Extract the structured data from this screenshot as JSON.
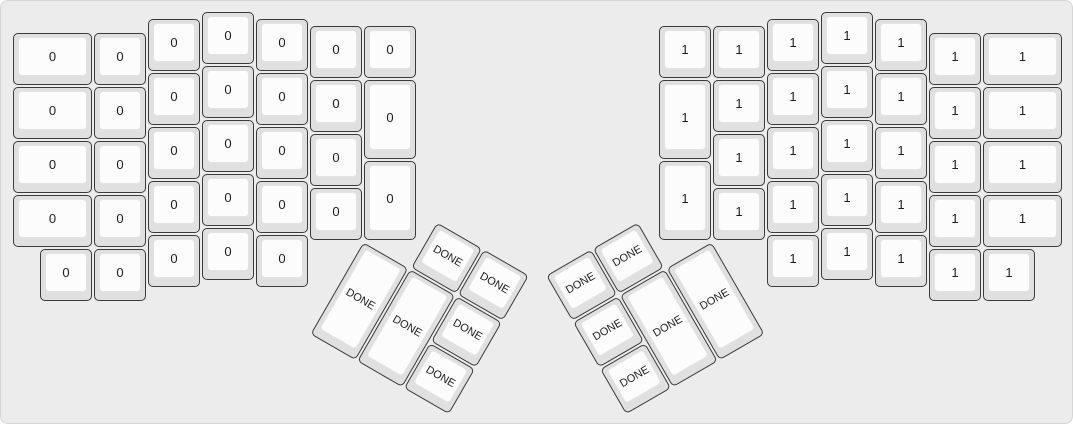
{
  "app": {
    "name": "keyboard-layout-preview",
    "background_color": "#ececec",
    "key_base_color": "#e0e0e0",
    "key_top_color": "#fcfcfc",
    "key_border_color": "#3b3b3b",
    "label_color": "#1c1c1c"
  },
  "keyboard": {
    "unit_px": 54,
    "groups": [
      {
        "name": "left-main",
        "rotation": 0,
        "origin": [
          0,
          0
        ],
        "keys": [
          {
            "x": 11,
            "y": 31,
            "w": 81,
            "h": 54,
            "label": "0"
          },
          {
            "x": 11,
            "y": 85,
            "w": 81,
            "h": 54,
            "label": "0"
          },
          {
            "x": 11,
            "y": 139,
            "w": 81,
            "h": 54,
            "label": "0"
          },
          {
            "x": 11,
            "y": 193,
            "w": 81,
            "h": 54,
            "label": "0"
          },
          {
            "x": 92,
            "y": 31,
            "w": 54,
            "h": 54,
            "label": "0"
          },
          {
            "x": 92,
            "y": 85,
            "w": 54,
            "h": 54,
            "label": "0"
          },
          {
            "x": 92,
            "y": 139,
            "w": 54,
            "h": 54,
            "label": "0"
          },
          {
            "x": 92,
            "y": 193,
            "w": 54,
            "h": 54,
            "label": "0"
          },
          {
            "x": 92,
            "y": 247,
            "w": 54,
            "h": 54,
            "label": "0"
          },
          {
            "x": 38,
            "y": 247,
            "w": 54,
            "h": 54,
            "label": "0"
          },
          {
            "x": 146,
            "y": 17,
            "w": 54,
            "h": 54,
            "label": "0"
          },
          {
            "x": 146,
            "y": 71,
            "w": 54,
            "h": 54,
            "label": "0"
          },
          {
            "x": 146,
            "y": 125,
            "w": 54,
            "h": 54,
            "label": "0"
          },
          {
            "x": 146,
            "y": 179,
            "w": 54,
            "h": 54,
            "label": "0"
          },
          {
            "x": 146,
            "y": 233,
            "w": 54,
            "h": 54,
            "label": "0"
          },
          {
            "x": 200,
            "y": 10,
            "w": 54,
            "h": 54,
            "label": "0"
          },
          {
            "x": 200,
            "y": 64,
            "w": 54,
            "h": 54,
            "label": "0"
          },
          {
            "x": 200,
            "y": 118,
            "w": 54,
            "h": 54,
            "label": "0"
          },
          {
            "x": 200,
            "y": 172,
            "w": 54,
            "h": 54,
            "label": "0"
          },
          {
            "x": 200,
            "y": 226,
            "w": 54,
            "h": 54,
            "label": "0"
          },
          {
            "x": 254,
            "y": 17,
            "w": 54,
            "h": 54,
            "label": "0"
          },
          {
            "x": 254,
            "y": 71,
            "w": 54,
            "h": 54,
            "label": "0"
          },
          {
            "x": 254,
            "y": 125,
            "w": 54,
            "h": 54,
            "label": "0"
          },
          {
            "x": 254,
            "y": 179,
            "w": 54,
            "h": 54,
            "label": "0"
          },
          {
            "x": 254,
            "y": 233,
            "w": 54,
            "h": 54,
            "label": "0"
          },
          {
            "x": 308,
            "y": 24,
            "w": 54,
            "h": 54,
            "label": "0"
          },
          {
            "x": 308,
            "y": 78,
            "w": 54,
            "h": 54,
            "label": "0"
          },
          {
            "x": 308,
            "y": 132,
            "w": 54,
            "h": 54,
            "label": "0"
          },
          {
            "x": 308,
            "y": 186,
            "w": 54,
            "h": 54,
            "label": "0"
          },
          {
            "x": 362,
            "y": 24,
            "w": 54,
            "h": 54,
            "label": "0"
          },
          {
            "x": 362,
            "y": 78,
            "w": 54,
            "h": 81,
            "label": "0"
          },
          {
            "x": 362,
            "y": 159,
            "w": 54,
            "h": 81,
            "label": "0"
          }
        ]
      },
      {
        "name": "left-thumb",
        "rotation": 30,
        "origin": [
          362,
          240
        ],
        "keys": [
          {
            "x": 54,
            "y": -54,
            "w": 54,
            "h": 54,
            "label": "DONE"
          },
          {
            "x": 108,
            "y": -54,
            "w": 54,
            "h": 54,
            "label": "DONE"
          },
          {
            "x": 0,
            "y": 0,
            "w": 54,
            "h": 108,
            "label": "DONE"
          },
          {
            "x": 54,
            "y": 0,
            "w": 54,
            "h": 108,
            "label": "DONE"
          },
          {
            "x": 108,
            "y": 0,
            "w": 54,
            "h": 54,
            "label": "DONE"
          },
          {
            "x": 108,
            "y": 54,
            "w": 54,
            "h": 54,
            "label": "DONE"
          }
        ]
      },
      {
        "name": "right-main",
        "rotation": 0,
        "origin": [
          0,
          0
        ],
        "keys": [
          {
            "x": 657,
            "y": 24,
            "w": 54,
            "h": 54,
            "label": "1"
          },
          {
            "x": 657,
            "y": 78,
            "w": 54,
            "h": 81,
            "label": "1"
          },
          {
            "x": 657,
            "y": 159,
            "w": 54,
            "h": 81,
            "label": "1"
          },
          {
            "x": 711,
            "y": 24,
            "w": 54,
            "h": 54,
            "label": "1"
          },
          {
            "x": 711,
            "y": 78,
            "w": 54,
            "h": 54,
            "label": "1"
          },
          {
            "x": 711,
            "y": 132,
            "w": 54,
            "h": 54,
            "label": "1"
          },
          {
            "x": 711,
            "y": 186,
            "w": 54,
            "h": 54,
            "label": "1"
          },
          {
            "x": 765,
            "y": 17,
            "w": 54,
            "h": 54,
            "label": "1"
          },
          {
            "x": 765,
            "y": 71,
            "w": 54,
            "h": 54,
            "label": "1"
          },
          {
            "x": 765,
            "y": 125,
            "w": 54,
            "h": 54,
            "label": "1"
          },
          {
            "x": 765,
            "y": 179,
            "w": 54,
            "h": 54,
            "label": "1"
          },
          {
            "x": 765,
            "y": 233,
            "w": 54,
            "h": 54,
            "label": "1"
          },
          {
            "x": 819,
            "y": 10,
            "w": 54,
            "h": 54,
            "label": "1"
          },
          {
            "x": 819,
            "y": 64,
            "w": 54,
            "h": 54,
            "label": "1"
          },
          {
            "x": 819,
            "y": 118,
            "w": 54,
            "h": 54,
            "label": "1"
          },
          {
            "x": 819,
            "y": 172,
            "w": 54,
            "h": 54,
            "label": "1"
          },
          {
            "x": 819,
            "y": 226,
            "w": 54,
            "h": 54,
            "label": "1"
          },
          {
            "x": 873,
            "y": 17,
            "w": 54,
            "h": 54,
            "label": "1"
          },
          {
            "x": 873,
            "y": 71,
            "w": 54,
            "h": 54,
            "label": "1"
          },
          {
            "x": 873,
            "y": 125,
            "w": 54,
            "h": 54,
            "label": "1"
          },
          {
            "x": 873,
            "y": 179,
            "w": 54,
            "h": 54,
            "label": "1"
          },
          {
            "x": 873,
            "y": 233,
            "w": 54,
            "h": 54,
            "label": "1"
          },
          {
            "x": 927,
            "y": 31,
            "w": 54,
            "h": 54,
            "label": "1"
          },
          {
            "x": 927,
            "y": 85,
            "w": 54,
            "h": 54,
            "label": "1"
          },
          {
            "x": 927,
            "y": 139,
            "w": 54,
            "h": 54,
            "label": "1"
          },
          {
            "x": 927,
            "y": 193,
            "w": 54,
            "h": 54,
            "label": "1"
          },
          {
            "x": 927,
            "y": 247,
            "w": 54,
            "h": 54,
            "label": "1"
          },
          {
            "x": 981,
            "y": 247,
            "w": 54,
            "h": 54,
            "label": "1"
          },
          {
            "x": 981,
            "y": 31,
            "w": 81,
            "h": 54,
            "label": "1"
          },
          {
            "x": 981,
            "y": 85,
            "w": 81,
            "h": 54,
            "label": "1"
          },
          {
            "x": 981,
            "y": 139,
            "w": 81,
            "h": 54,
            "label": "1"
          },
          {
            "x": 981,
            "y": 193,
            "w": 81,
            "h": 54,
            "label": "1"
          }
        ]
      },
      {
        "name": "right-thumb",
        "rotation": -30,
        "origin": [
          711,
          240
        ],
        "keys": [
          {
            "x": -108,
            "y": -54,
            "w": 54,
            "h": 54,
            "label": "DONE"
          },
          {
            "x": -162,
            "y": -54,
            "w": 54,
            "h": 54,
            "label": "DONE"
          },
          {
            "x": -162,
            "y": 0,
            "w": 54,
            "h": 54,
            "label": "DONE"
          },
          {
            "x": -108,
            "y": 0,
            "w": 54,
            "h": 108,
            "label": "DONE"
          },
          {
            "x": -54,
            "y": 0,
            "w": 54,
            "h": 108,
            "label": "DONE"
          },
          {
            "x": -162,
            "y": 54,
            "w": 54,
            "h": 54,
            "label": "DONE"
          }
        ]
      }
    ]
  }
}
